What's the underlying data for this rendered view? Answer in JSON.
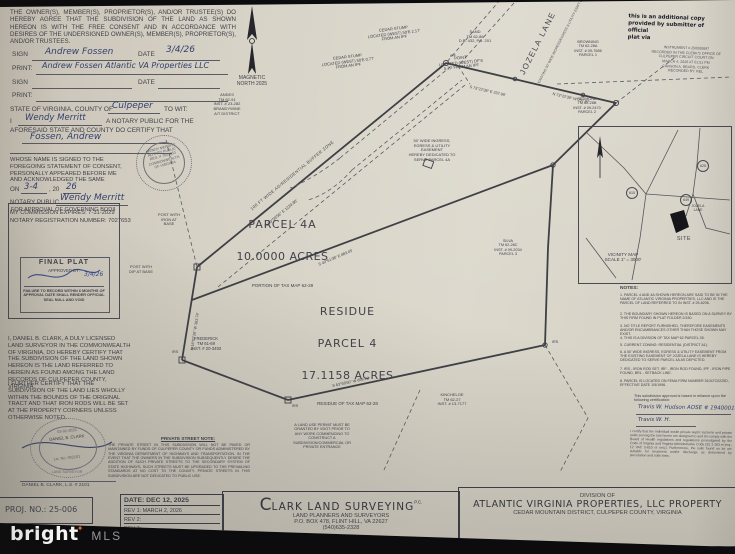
{
  "consent": {
    "text": "THE OWNER(S), MEMBER(S), PROPRIETOR(S), AND/OR TRUSTEE(S) DO HEREBY AGREE THAT THE SUBDIVISION OF THE LAND AS SHOWN HEREON IS WITH THE FREE CONSENT AND IN ACCORDANCE WITH DESIRES OF THE UNDERSIGNED OWNER(S), MEMBER(S), PROPRIETOR(S), AND/OR TRUSTEES.",
    "sign_label": "SIGN",
    "date_label": "DATE",
    "print_label": "PRINT:",
    "sign1_name": "Andrew Fossen",
    "sign1_date": "3/4/26",
    "print1_value": "Andrew Fossen  Atlantic VA Properties LLC"
  },
  "notary": {
    "state_prefix": "STATE OF VIRGINIA, COUNTY OF",
    "county": "Culpeper",
    "to_wit": "TO WIT:",
    "i": "I",
    "name": "Wendy Merritt",
    "intro_rest": "A NOTARY PUBLIC FOR THE",
    "intro2": "AFORESAID STATE AND COUNTY DO CERTIFY THAT",
    "subject": "Fossen, Andrew",
    "body": "WHOSE NAME IS SIGNED TO THE FOREGOING STATEMENT OF CONSENT, PERSONALLY APPEARED BEFORE ME AND ACKNOWLEDGED THE SAME",
    "on_label": "ON",
    "on_date": "3-4",
    "year20": ", 20",
    "year": "26",
    "public_label": "NOTARY PUBLIC",
    "signature": "Wendy Merritt",
    "expires": "MY COMMISSION EXPIRES:  7-31-2029",
    "reg": "NOTARY REGISTRATION NUMBER: 7027653",
    "seal": "WENDY MERRITT\nNOTARY PUBLIC\nREG. # 7027653\nCOMMONWEALTH\nOF VIRGINIA"
  },
  "governing": {
    "title": "FOR APPROVAL OF GOVERNING BODIES"
  },
  "stamp": {
    "title": "FINAL PLAT",
    "approved": "APPROVED BY:",
    "date": "3/4/26",
    "warning": "FAILURE TO RECORD WITHIN 6 MONTHS OF APPROVAL DATE SHALL RENDER OFFICIAL SEAL NULL AND VOID"
  },
  "cert": {
    "p1": "I, DANIEL B. CLARK, A DULY LICENSED LAND SURVEYOR IN THE COMMONWEALTH OF VIRGINIA, DO HEREBY CERTIFY THAT THE SUBDIVISION OF THE LAND SHOWN HEREON IS THE LAND REFERRED TO HEREIN AS FOUND AMONG THE LAND RECORDS OF CULPEPER COUNTY, VIRGINIA.",
    "p2": "I FURTHER CERTIFY THAT THE SUBDIVISION OF THE LAND LIES WHOLLY WITHIN THE BOUNDS OF THE ORIGINAL TRACT AND THAT IRON RODS WILL BE SET AT THE PROPERTY CORNERS UNLESS OTHERWISE NOTED."
  },
  "seal2": {
    "state": "COMMONWEALTH OF VIRGINIA",
    "date": "03-02-2026",
    "name": "DANIEL B. CLARK",
    "lic": "Lic. No. 002101",
    "title": "LAND SURVEYOR",
    "sig_name": "DANIEL B. CLARK, L.S. # 2101"
  },
  "psn": {
    "title": "PRIVATE STREET NOTE:",
    "text": "THE PRIVATE STREET IN THIS SUBDIVISION WILL NOT BE PAVED OR MAINTAINED BY FUNDS OF CULPEPER COUNTY OR FUNDS ADMINISTERED BY THE VIRGINIA DEPARTMENT OF HIGHWAYS AND TRANSPORTATION. IN THE EVENT THAT THE OWNERS IN THE SUBDIVISION SUBSEQUENTLY DESIRE THE ADDITION OF SUCH PRIVATE STREETS TO THE SECONDARY SYSTEM OF STATE HIGHWAYS, SUCH STREETS MUST BE UPGRADED TO THE PREVAILING STANDARDS AT NO COST TO THE COUNTY. PRIVATE STREETS IN THIS SUBDIVISION ARE NOT DEDICATED TO PUBLIC USE."
  },
  "map": {
    "north": "MAGNETIC\nNORTH 2025",
    "parcel4a": {
      "name": "PARCEL 4A",
      "acres": "10.0000 ACRES",
      "sub": "PORTION OF TAX MAP 62-28"
    },
    "residue": {
      "l1": "RESIDUE",
      "l2": "PARCEL 4",
      "acres": "17.1158 ACRES",
      "sub": "RESIDUE OF TAX MAP 62-28"
    },
    "adjoiners": {
      "andes": "ANDES\nTM 62-91\nINST. # 23-282\nBRANDYWINE\nA/T DISTRICT",
      "frederick": "FREDERICK\nTM 61-69\nINST. # 20-3493",
      "kincheloe": "KINCHELOE\nTM 62-27\nINST. # 13-7177",
      "silva": "SILVA\nTM 62-28C\nINST. # 09-2034\nPARCEL 3",
      "browning": "BROWNING\nTM 62-28A\nINST. # 09-7686\nPARCEL 1",
      "redmond": "REDMOND\nTM 62-28B\nINST. # 09-2470\nPARCEL 2",
      "sand": "SAND\nTM 62-86\nD.B. 432, PG. 201"
    },
    "features": {
      "jozela": "JOZELA LANE",
      "jozela_esmt": "EXISTING 50' WIDE INGRESS/EGRESS & UTILITY ESM'T (PLAT FOLDER 2/150)",
      "buffer": "100 FT WIDE AG/RESIDENTIAL BUFFER ZONE",
      "easement": "50' WIDE INGRESS,\nEGRESS & UTILITY\nEASEMENT\nHEREBY DEDICATED TO\nSERVE PARCEL 4A",
      "cedar1": "CEDAR STUMP\nLOCATED (WEST) 50'E 2.17'\nFROM AN IPF",
      "cedar2": "CEDAR STUMP\nLOCATED (WEST) 50'E 0.77'\nFROM AN IPF",
      "point": "POINT\nLOCATED (WEST) OF'S\n5.29' FROM AN IPF",
      "post_iron": "POST WITH\nIRON AT\nBASE",
      "post_dip": "POST WITH\nDIP AT BASE",
      "vdot": "A LAND USE PERMIT MUST BE\nGRANTED BY VDOT PRIOR TO\nANY WORK COMMENCING TO\nCONSTRUCT A\nSUBDIVISION/COMMERCIAL OR\nPRIVATE ENTRANCE"
    },
    "bearings": {
      "a": "N 59°59'56\" E   1229.86'",
      "ne1": "S 73°22'38\" E  237.99'",
      "ne2": "N 73°22'38\" W  237.97'",
      "interior": "S 49°51'38\" E   883.05'",
      "bottom": "S 63°58'50\" W   658.22'",
      "left": "N 16°07'26\" W  383.74'"
    },
    "markers": {
      "irs": "IRS",
      "ipf": "IPF"
    }
  },
  "vicinity": {
    "title_scale": "VICINITY MAP\nSCALE 1\" = 3000'",
    "site": "SITE",
    "road": "JOZELA\nLANE",
    "routes": [
      "615",
      "625",
      "649"
    ]
  },
  "notes": {
    "title": "NOTES:",
    "items": [
      "1. PARCEL 4 AND 4A SHOWN HEREON ARE SAID TO BE IN THE NAME OF ATLANTIC VIRGINIA PROPERTIES, LLC AND IS THE PARCEL OF LAND REFERRED TO IN INST. # 25-6206.",
      "2. THE BOUNDARY SHOWN HEREON IS BASED ON A SURVEY BY THIS FIRM FOUND IN PLAT FOLDER 2/150.",
      "3. NO TITLE REPORT FURNISHED, THEREFORE EASEMENTS AND/OR ENCUMBRANCES OTHER THAN THOSE SHOWN MAY EXIST.",
      "4. THIS IS A DIVISION OF TAX MAP 62 PARCEL 28.",
      "5. CURRENT ZONING: RESIDENTIAL (DISTRICT A1).",
      "6. A 50' WIDE INGRESS, EGRESS & UTILITY EASEMENT FROM THE EXISTING EASEMENT OF JOZELA LANE IS HEREBY DEDICATED TO SERVE PARCEL 4A AS DEPICTED.",
      "7. IRS - IRON ROD SET, IRF - IRON ROD FOUND, IPF - IRON PIPE FOUND, BRL - SETBACK LINE.",
      "8. PARCEL IS LOCATED ON FEMA FIRM NUMBER 51047C0225D, EFFECTIVE DATE 1/5/1996."
    ]
  },
  "certification": {
    "note": "This subdivision approval is based in reliance upon the following certification:",
    "sig1": "Travis W. Hudson   AOSE # 1940001434",
    "sig2": "Travis W. H.",
    "health": "I certify that the individual onsite private septic systems and private wells serving the lots herein are designed to and do comply with the Board of Health regulations and regulations promulgated by the Code of Virginia and Virginia Administrative Code (32.1-163 et seq.; 12 VAC 5-610 et seq.). Furthermore, the soils found on lot are suitable for treatment and/or discharge as determined by percolation and soils tests."
  },
  "recording": {
    "copy_note": "this is an additional copy\nprovided by submitter of official\nplat via",
    "instrument": "INSTRUMENT # 250000697\nRECORDED IN THE CLERK'S OFFICE OF\nCULPEPER CIRCUIT COURT ON\nMARCH 4, 2026 AT 01:51 PM\nCARSON A. BEARD, CLERK\nRECORDED BY: REL"
  },
  "tb": {
    "proj": "PROJ. NO.: 25-006",
    "date": "DATE: DEC 12, 2025",
    "rev1": "REV 1:   MARCH 2, 2026",
    "rev2": "REV 2:",
    "rev3": "REV 3:",
    "rev4": "REV 4:",
    "firm_c": "C",
    "firm_name": "LARK LAND SURVEYING",
    "firm_pc": "P.C.",
    "firm_sub": "LAND PLANNERS AND SURVEYORS",
    "firm_addr": "P.O. BOX 478, FLINT HILL, VA 22627",
    "firm_phone": "(540)635-2328",
    "division": "DIVISION OF",
    "owner": "ATLANTIC VIRGINIA PROPERTIES, LLC PROPERTY",
    "district": "CEDAR MOUNTAIN DISTRICT, CULPEPER COUNTY, VIRGINIA"
  },
  "wm": {
    "brand": "bright",
    "spark": "✦",
    "mls": "MLS"
  },
  "colors": {
    "paper": "#d7d2c6",
    "ink": "#41414a",
    "handwriting": "#33406e",
    "accent_orange": "#e8622d"
  }
}
